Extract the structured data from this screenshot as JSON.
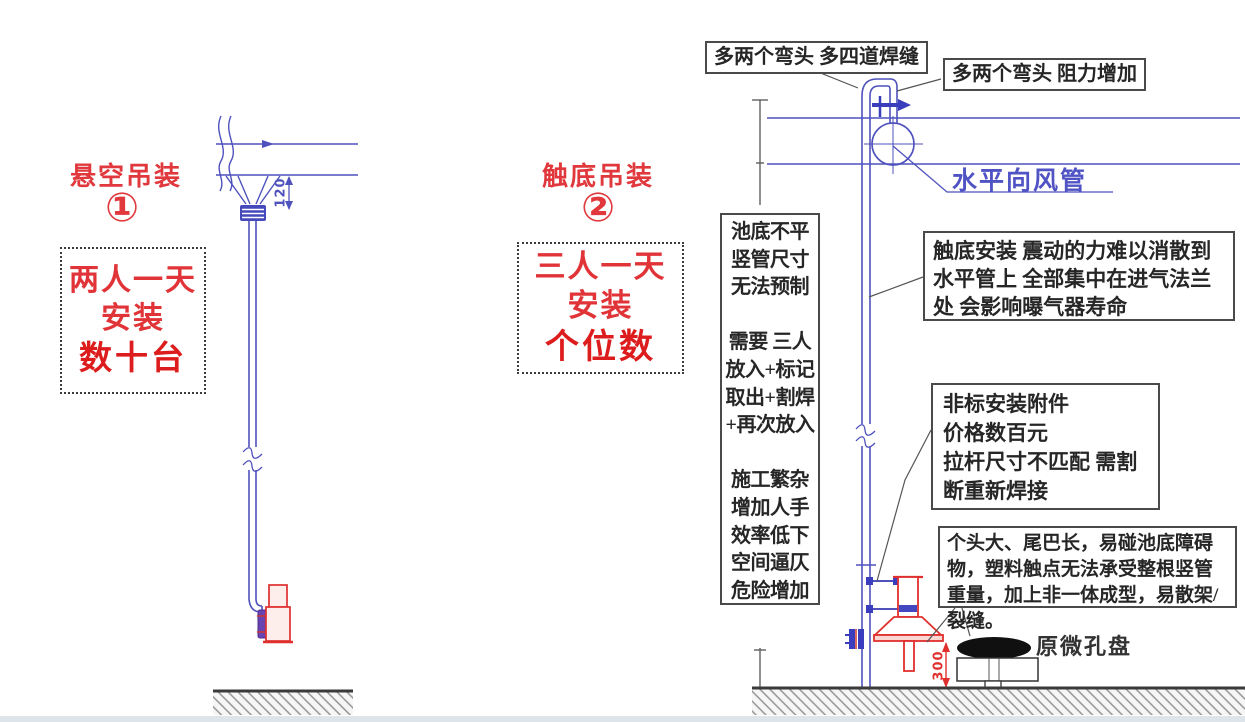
{
  "colors": {
    "annotation_red": "#e0383c",
    "drawing_blue": "#4f52bd",
    "text_dark": "#262626",
    "diffuser_red": "#e0302e"
  },
  "method1": {
    "title": "悬空吊装",
    "number": "①",
    "summary_lines": [
      "两人一天",
      "安装",
      "数十台"
    ]
  },
  "method2": {
    "title": "触底吊装",
    "number": "②",
    "summary_lines": [
      "三人一天",
      "安装",
      "个位数"
    ]
  },
  "issues_panel": {
    "lines": [
      "池底不平",
      "竖管尺寸",
      "无法预制",
      "",
      "需要 三人",
      "放入+标记",
      "取出+割焊",
      "+再次放入",
      "",
      "施工繁杂",
      "增加人手",
      "效率低下",
      "空间逼仄",
      "危险增加"
    ]
  },
  "callouts": {
    "extra_elbows_welds": "多两个弯头 多四道焊缝",
    "extra_elbows_resistance": "多两个弯头 阻力增加",
    "horizontal_duct_label": "水平向风管",
    "vibration_note": "触底安装 震动的力难以消散到水平管上 全部集中在进气法兰处 会影响曝气器寿命",
    "nonstandard_lines": [
      "非标安装附件",
      "价格数百元",
      "拉杆尺寸不匹配 需割",
      "断重新焊接"
    ],
    "bulky_note": "个头大、尾巴长，易碰池底障碍物，塑料触点无法承受整根竖管重量，加上非一体成型，易散架/裂缝。",
    "micro_disc_label": "原微孔盘"
  },
  "dimensions": {
    "hanging_clearance": "120",
    "bottom_clearance": "300"
  }
}
